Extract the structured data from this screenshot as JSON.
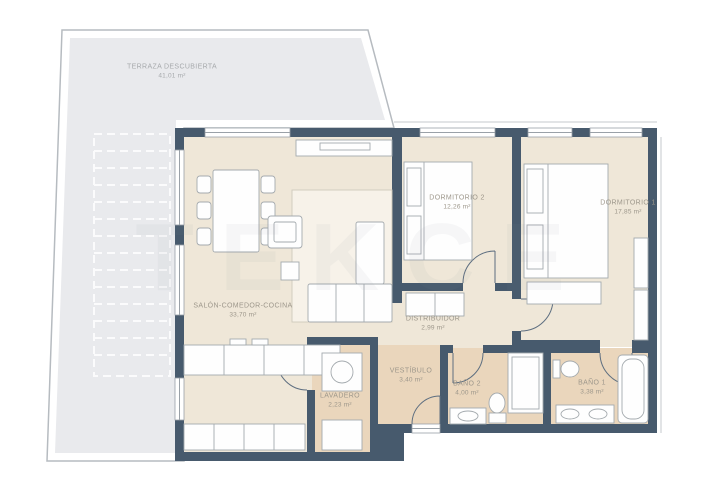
{
  "watermark": "TEKCE",
  "rooms": [
    {
      "id": "terraza",
      "name": "TERRAZA DESCUBIERTA",
      "area": "41,01 m²"
    },
    {
      "id": "salon",
      "name": "SALÓN-COMEDOR-COCINA",
      "area": "33,70 m²"
    },
    {
      "id": "dormitorio-2",
      "name": "DORMITORIO 2",
      "area": "12,26 m²"
    },
    {
      "id": "dormitorio-1",
      "name": "DORMITORIO 1",
      "area": "17,85 m²"
    },
    {
      "id": "distribuidor",
      "name": "DISTRIBUIDOR",
      "area": "2,99 m²"
    },
    {
      "id": "vestibulo",
      "name": "VESTÍBULO",
      "area": "3,40 m²"
    },
    {
      "id": "lavadero",
      "name": "LAVADERO",
      "area": "2,23 m²"
    },
    {
      "id": "bano-2",
      "name": "BAÑO 2",
      "area": "4,00 m²"
    },
    {
      "id": "bano-1",
      "name": "BAÑO 1",
      "area": "3,38 m²"
    }
  ],
  "colors": {
    "wall": "#475a6d",
    "floor_main": "#efe7d8",
    "floor_wet": "#e9d5bb",
    "terrace_floor": "#e9eaed",
    "label_text": "#9d978b"
  }
}
